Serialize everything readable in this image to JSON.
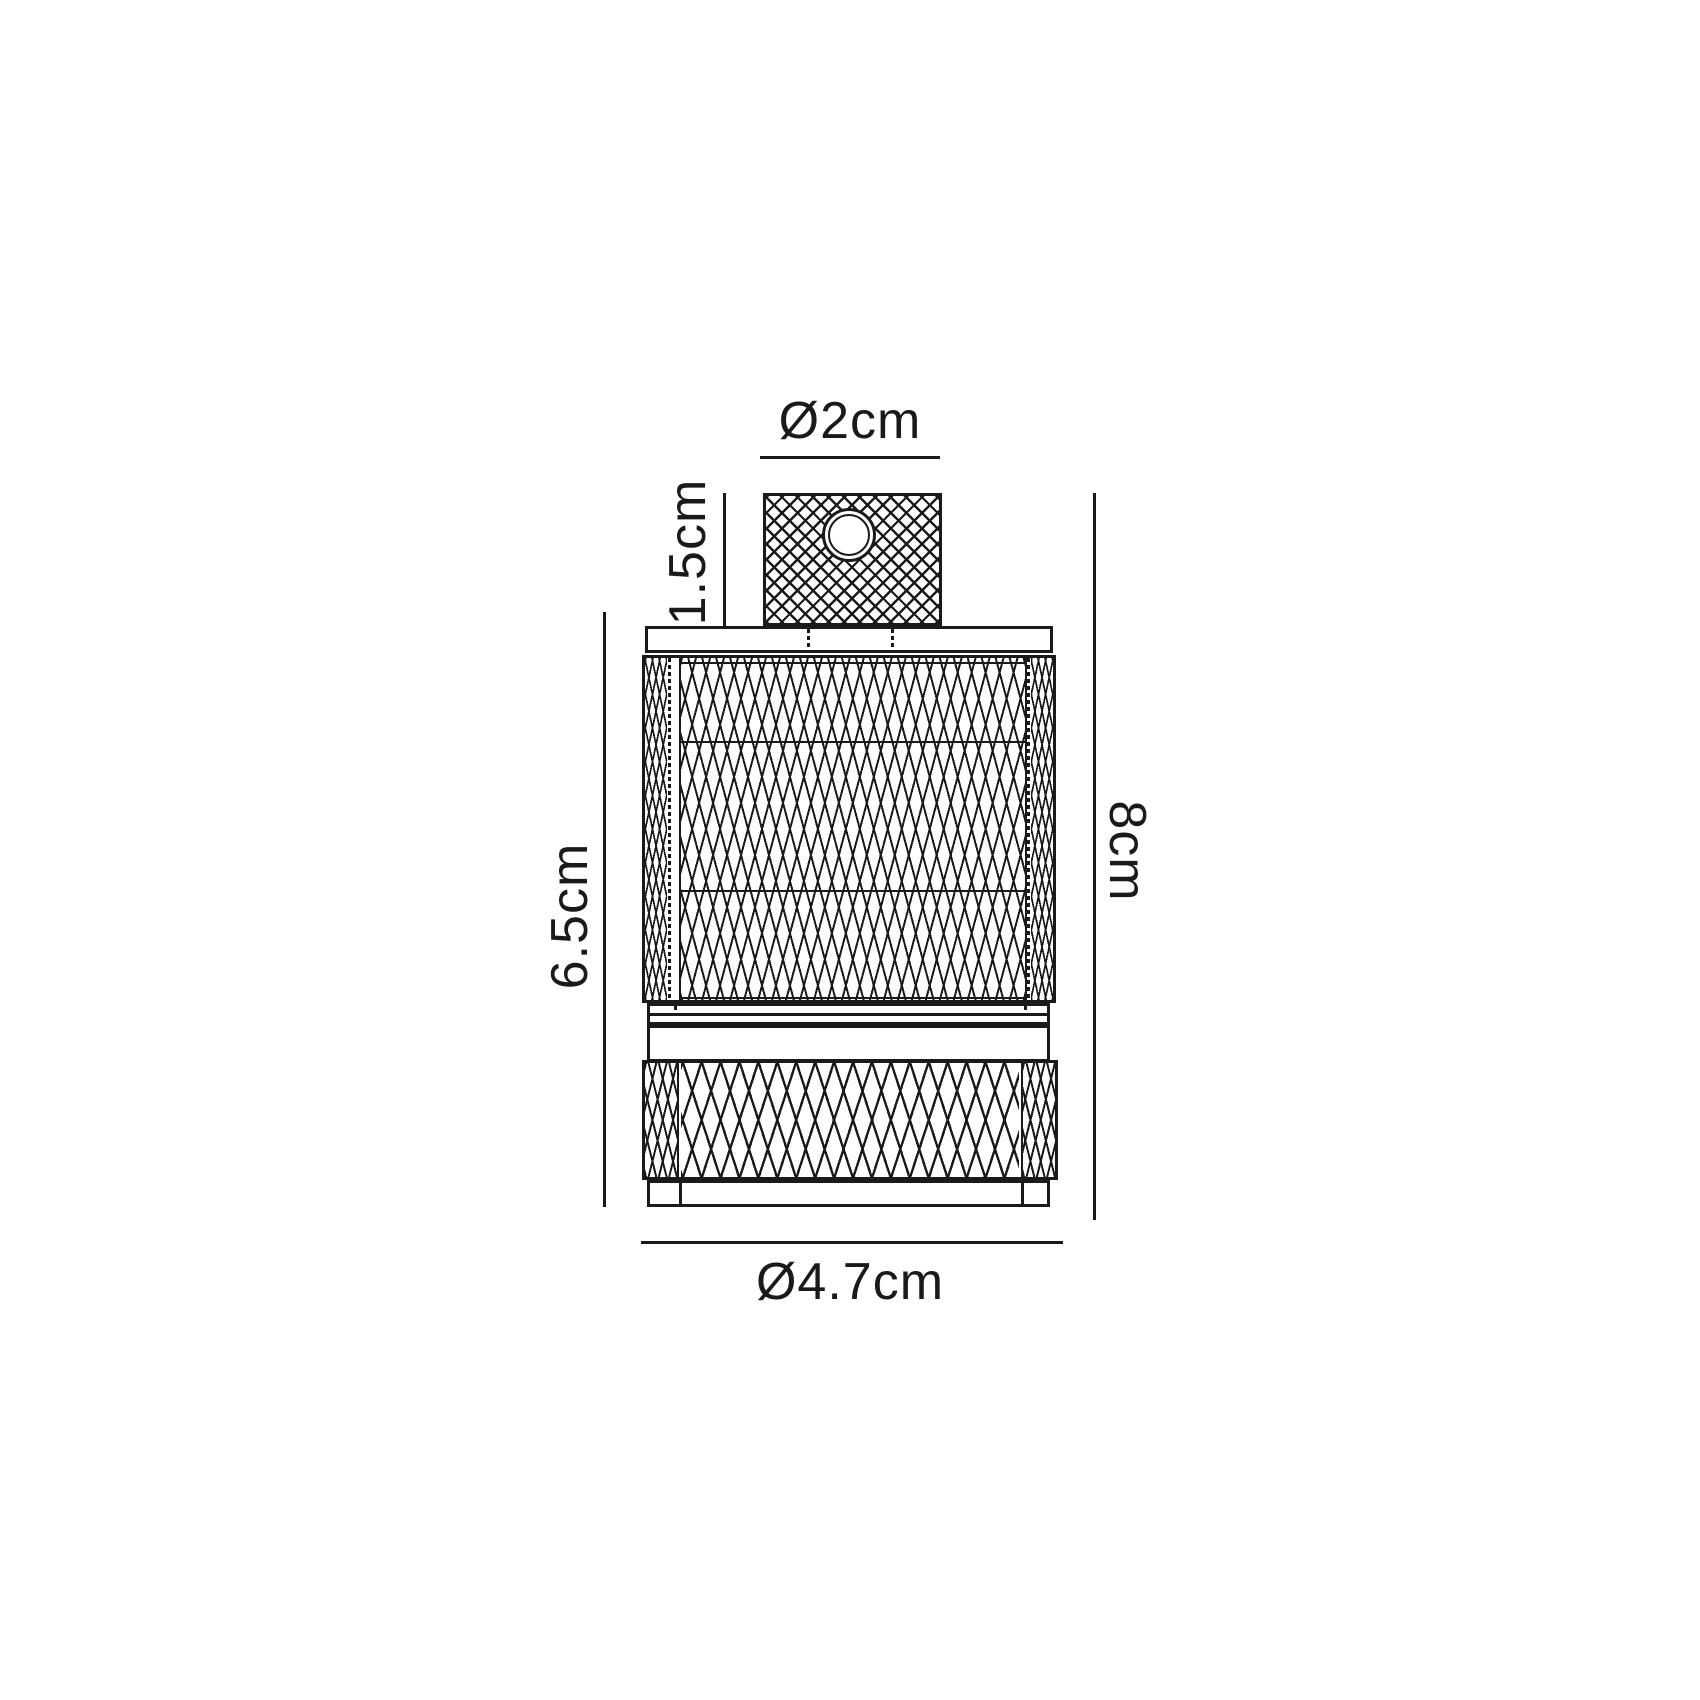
{
  "diagram": {
    "type": "technical dimension drawing",
    "subject": "knurled cylindrical lamp holder, front elevation",
    "background_color": "#ffffff",
    "line_color": "#1a1a1a",
    "dimensions": {
      "top_diameter": "Ø2cm",
      "cap_height": "1.5cm",
      "body_height": "6.5cm",
      "total_height": "8cm",
      "base_diameter": "Ø4.7cm"
    }
  }
}
